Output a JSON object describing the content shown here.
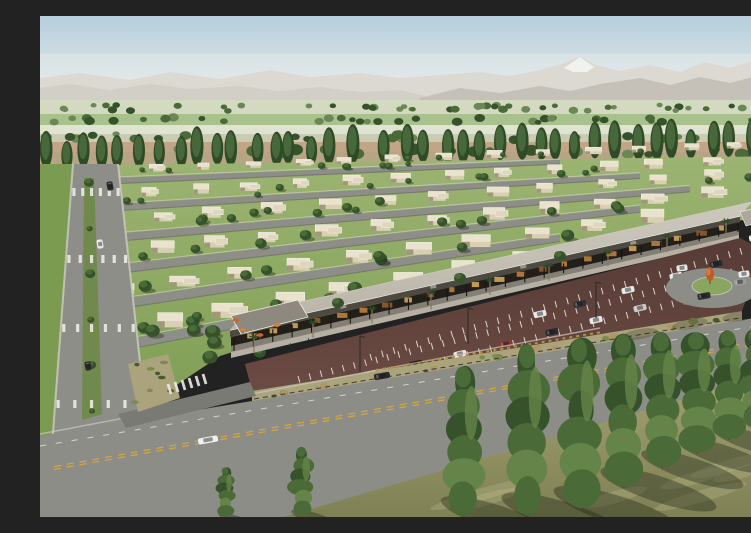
{
  "scene": {
    "meta": {
      "description": "Aerial architectural rendering of a desert master-planned community: rows of beige single-story homes with lawns, poplar-lined farm fields and hazy mountains with one snow peak behind, a retail strip with flat canopy, palm trees and orange cafe umbrellas, a maroon striped parking lot with cars, a landscaped boulevard, a roundabout with an orange feature tree, and a wide foreground road lined with tall columnar trees casting shadows on olive grass",
      "width": 751,
      "height": 501
    },
    "seed": 7,
    "sky": {
      "stops": [
        [
          "0%",
          "#b7cedd"
        ],
        [
          "55%",
          "#d6e1e4"
        ],
        [
          "100%",
          "#edeee6"
        ]
      ]
    },
    "mountains": {
      "base_y": 96,
      "back": [
        [
          0,
          62
        ],
        [
          40,
          57
        ],
        [
          90,
          64
        ],
        [
          130,
          56
        ],
        [
          180,
          63
        ],
        [
          230,
          54
        ],
        [
          270,
          61
        ],
        [
          320,
          57
        ],
        [
          360,
          62
        ],
        [
          400,
          59
        ],
        [
          440,
          56
        ],
        [
          470,
          60
        ],
        [
          500,
          54
        ],
        [
          524,
          47
        ],
        [
          540,
          40
        ],
        [
          556,
          49
        ],
        [
          580,
          55
        ],
        [
          610,
          49
        ],
        [
          640,
          56
        ],
        [
          665,
          46
        ],
        [
          690,
          52
        ],
        [
          715,
          44
        ],
        [
          750,
          49
        ]
      ],
      "front_left": [
        [
          0,
          72
        ],
        [
          30,
          68
        ],
        [
          70,
          74
        ],
        [
          110,
          68
        ],
        [
          150,
          73
        ],
        [
          200,
          70
        ],
        [
          240,
          75
        ],
        [
          280,
          71
        ],
        [
          320,
          76
        ],
        [
          360,
          74
        ],
        [
          385,
          80
        ]
      ],
      "front_right": [
        [
          380,
          82
        ],
        [
          420,
          72
        ],
        [
          460,
          77
        ],
        [
          500,
          70
        ],
        [
          530,
          75
        ],
        [
          560,
          68
        ],
        [
          600,
          62
        ],
        [
          630,
          69
        ],
        [
          660,
          61
        ],
        [
          690,
          67
        ],
        [
          720,
          59
        ],
        [
          750,
          63
        ]
      ],
      "snow": [
        [
          524,
          52
        ],
        [
          540,
          41
        ],
        [
          554,
          51
        ],
        [
          547,
          56
        ],
        [
          533,
          56
        ]
      ]
    },
    "fields": {
      "strips": [
        [
          84,
          14,
          "#d3dac1"
        ],
        [
          98,
          11,
          "#a9c18d"
        ],
        [
          109,
          9,
          "#dfe3d2"
        ],
        [
          118,
          8,
          "#c9ccb3"
        ],
        [
          126,
          10,
          "#c2a486"
        ],
        [
          136,
          14,
          "#b5a584"
        ]
      ],
      "tree_bands": [
        [
          92,
          46,
          3.5
        ],
        [
          104,
          34,
          4
        ],
        [
          121,
          26,
          4.5
        ],
        [
          136,
          22,
          5.5
        ]
      ]
    },
    "poplars": {
      "x0": 4,
      "x1": 748,
      "y0": 152,
      "y1": 140,
      "count": 40,
      "h_min": 28,
      "h_max": 40
    },
    "residential": {
      "area": [
        [
          0,
          150
        ],
        [
          750,
          140
        ],
        [
          750,
          200
        ],
        [
          660,
          208
        ],
        [
          430,
          262
        ],
        [
          180,
          340
        ],
        [
          60,
          420
        ],
        [
          0,
          424
        ]
      ],
      "streets": [
        [
          168,
          520,
          146,
          6
        ],
        [
          196,
          600,
          160,
          7
        ],
        [
          228,
          650,
          173,
          8
        ],
        [
          262,
          600,
          193,
          9
        ],
        [
          300,
          520,
          222,
          10
        ],
        [
          345,
          420,
          265,
          11
        ]
      ],
      "house_rows": [
        [
          160,
          0.04,
          16,
          13,
          7,
          8,
          740
        ],
        [
          186,
          0.055,
          15,
          16,
          9,
          0,
          710
        ],
        [
          214,
          0.075,
          14,
          18,
          10,
          0,
          720
        ],
        [
          248,
          0.1,
          13,
          20,
          11,
          0,
          660
        ],
        [
          288,
          0.135,
          11,
          23,
          12,
          15,
          600
        ],
        [
          332,
          0.175,
          8,
          26,
          14,
          55,
          470
        ]
      ],
      "orchard_cluster": {
        "x0": 140,
        "x1": 270,
        "y0": 295,
        "y1": 350,
        "count": 9
      }
    },
    "boulevard": {
      "poly": [
        [
          33,
          148
        ],
        [
          78,
          148
        ],
        [
          108,
          418
        ],
        [
          12,
          430
        ]
      ],
      "verge": [
        [
          0,
          148
        ],
        [
          33,
          148
        ],
        [
          12,
          430
        ],
        [
          0,
          432
        ]
      ],
      "median": [
        [
          44,
          162
        ],
        [
          54,
          162
        ],
        [
          62,
          398
        ],
        [
          42,
          404
        ]
      ],
      "median_tree_count": 6,
      "crosswalk_ys": [
        176,
        243,
        312,
        388
      ],
      "cars": [
        [
          60,
          228,
          "#e9e9e7"
        ],
        [
          70,
          170,
          "#2c2c30"
        ],
        [
          48,
          350,
          "#2c2c30"
        ]
      ]
    },
    "strip_mall": {
      "plaza": [
        [
          191,
          330
        ],
        [
          699,
          214
        ],
        [
          699,
          224
        ],
        [
          191,
          342
        ]
      ],
      "canopy_shadow": [
        [
          191,
          330
        ],
        [
          699,
          214
        ],
        [
          699,
          219
        ],
        [
          191,
          336
        ]
      ],
      "under": [
        [
          191,
          321
        ],
        [
          699,
          206
        ],
        [
          699,
          214
        ],
        [
          191,
          330
        ]
      ],
      "fascia": [
        [
          190,
          314
        ],
        [
          700,
          200
        ],
        [
          700,
          206
        ],
        [
          190,
          321
        ]
      ],
      "roof": [
        [
          190,
          314
        ],
        [
          700,
          200
        ],
        [
          712,
          186
        ],
        [
          202,
          299
        ]
      ],
      "gable": [
        [
          191,
          300
        ],
        [
          258,
          284
        ],
        [
          268,
          301
        ],
        [
          201,
          318
        ]
      ],
      "roof_units": [
        [
          300,
          290
        ],
        [
          390,
          270
        ],
        [
          480,
          250
        ],
        [
          590,
          226
        ]
      ],
      "roof_trees": [
        [
          298,
          287
        ],
        [
          420,
          262
        ],
        [
          520,
          240
        ]
      ],
      "glow_count": 22,
      "column_count": 27,
      "palms": {
        "x0": 214,
        "x1": 686,
        "y0": 336,
        "y1": 222,
        "count": 9
      },
      "umbrellas": [
        [
          203,
          318
        ],
        [
          220,
          323
        ],
        [
          237,
          313
        ],
        [
          196,
          308
        ]
      ],
      "people": [
        [
          250,
          330
        ],
        [
          268,
          325
        ],
        [
          300,
          320
        ],
        [
          330,
          312
        ],
        [
          360,
          306
        ]
      ]
    },
    "parking": {
      "poly": [
        [
          205,
          348
        ],
        [
          700,
          222
        ],
        [
          724,
          234
        ],
        [
          702,
          295
        ],
        [
          212,
          375
        ]
      ],
      "stripe_rows": [
        [
          245,
          380,
          700,
          268,
          40
        ],
        [
          258,
          360,
          702,
          250,
          40
        ],
        [
          330,
          338,
          700,
          232,
          32
        ]
      ],
      "cars": [
        [
          236,
          378,
          "#26262a"
        ],
        [
          283,
          370,
          "#e8e8e6"
        ],
        [
          330,
          358,
          "#bfc0c0"
        ],
        [
          376,
          348,
          "#1d1d21"
        ],
        [
          420,
          338,
          "#e6e6e4"
        ],
        [
          466,
          328,
          "#8a3a32"
        ],
        [
          512,
          316,
          "#2a2a2e"
        ],
        [
          556,
          304,
          "#e8e8e6"
        ],
        [
          600,
          292,
          "#c9c9c7"
        ],
        [
          648,
          280,
          "#2f2f33"
        ],
        [
          500,
          298,
          "#e8e8e6"
        ],
        [
          540,
          288,
          "#33343a"
        ],
        [
          588,
          274,
          "#e8e8e6"
        ],
        [
          636,
          260,
          "#e8e8e6"
        ],
        [
          676,
          248,
          "#2b2b2f"
        ]
      ]
    },
    "berm": {
      "poly": [
        [
          212,
          386
        ],
        [
          702,
          305
        ],
        [
          702,
          295
        ],
        [
          212,
          375
        ]
      ],
      "shrub_count": 20,
      "rail_a": [
        [
          214,
          383
        ],
        [
          700,
          302
        ]
      ],
      "rail_b": [
        [
          214,
          387
        ],
        [
          700,
          306
        ]
      ]
    },
    "roundabout": {
      "cx": 672,
      "cy": 272,
      "rx": 46,
      "ry": 20,
      "island_rx": 20,
      "island_ry": 9,
      "feature": [
        670,
        258
      ],
      "cars": [
        [
          704,
          258,
          "#ececea"
        ],
        [
          642,
          252,
          "#e8e8e6"
        ]
      ]
    },
    "right_edge": {
      "canopy": [
        [
          700,
          196
        ],
        [
          750,
          184
        ],
        [
          750,
          198
        ],
        [
          706,
          210
        ]
      ],
      "sign": [
        732,
        204,
        14,
        9
      ],
      "cars": [
        [
          714,
          222,
          "#e8e8e6"
        ],
        [
          736,
          228,
          "#d8d8d6"
        ]
      ]
    },
    "main_road": {
      "poly": [
        [
          0,
          420
        ],
        [
          750,
          296
        ],
        [
          750,
          352
        ],
        [
          250,
          501
        ],
        [
          0,
          501
        ]
      ],
      "access_road": [
        [
          78,
          398
        ],
        [
          210,
          366
        ],
        [
          216,
          380
        ],
        [
          86,
          412
        ]
      ],
      "island": [
        [
          88,
          348
        ],
        [
          128,
          338
        ],
        [
          140,
          382
        ],
        [
          98,
          396
        ]
      ],
      "center_line": [
        [
          14,
          452
        ],
        [
          744,
          322
        ]
      ],
      "edge_dash": [
        [
          0,
          430
        ],
        [
          740,
          306
        ]
      ],
      "curb_ticks": [
        [
          336,
          354
        ],
        [
          562,
          316
        ]
      ],
      "crosswalk_access": {
        "x0": 128,
        "y0": 368,
        "count": 6
      },
      "cars": [
        [
          168,
          424,
          "#efefed",
          20
        ],
        [
          342,
          360,
          "#2b2b2f",
          16
        ],
        [
          664,
          280,
          "#2e2e32",
          13
        ],
        [
          700,
          266,
          "#9a9a98",
          12
        ]
      ],
      "road_shadows": [
        [
          600,
          318
        ],
        [
          650,
          308
        ],
        [
          700,
          300
        ],
        [
          740,
          294
        ]
      ]
    },
    "foreground": {
      "grass": [
        [
          244,
          501
        ],
        [
          750,
          352
        ],
        [
          750,
          501
        ]
      ],
      "streak_count": 7,
      "trees": [
        [
          186,
          452,
          501
        ],
        [
          262,
          432,
          501
        ],
        [
          424,
          352,
          501
        ],
        [
          488,
          330,
          501
        ],
        [
          540,
          324,
          494
        ],
        [
          584,
          320,
          472
        ],
        [
          622,
          318,
          452
        ],
        [
          657,
          318,
          438
        ],
        [
          689,
          316,
          424
        ],
        [
          716,
          314,
          412
        ],
        [
          741,
          313,
          402
        ]
      ],
      "poles": [
        [
          320,
          320
        ],
        [
          428,
          292
        ],
        [
          556,
          266
        ]
      ]
    }
  },
  "palette": {
    "mtn_back": "#d2ccc2",
    "mtn_front_left": "#c2bbae",
    "mtn_front_right": "#a89f90",
    "snow": "#f5f3ef",
    "haze": "rgba(235,238,238,0.4)",
    "horizon_trees": "#7e9468",
    "poplar_dark": "#2f4a26",
    "poplar_mid": "#47683a",
    "lawn_top": "#9cb472",
    "lawn_bottom": "#7b9b50",
    "street": "#8e8e88",
    "street_dark": "#6c6c66",
    "sidewalk": "#cbc9c0",
    "house_wall": "#d9cfb3",
    "house_roof": "#e9e2cd",
    "house_wing": "#ded6bf",
    "house_shadow": "#a2967b",
    "house_trim": "#f4f0e4",
    "tree_dark": "#35522b",
    "tree_mid": "#4a6b37",
    "tree_light": "#648449",
    "canopy": "#b9b4a8",
    "canopy_light": "#ccc8bd",
    "fascia": "#4e4a42",
    "under_canopy": "#221f1b",
    "glow_a": "#b67a3a",
    "glow_b": "#8a5a2e",
    "glow_c": "#caa05a",
    "column": "#17150f",
    "plaza": "#b5b0a3",
    "gable_roof": "#8e897e",
    "parking_light": "#6b4b43",
    "parking_dark": "#573b36",
    "stall_stripe": "#e9e7e2",
    "road": "#8d8d87",
    "road_dark": "#7a7a74",
    "center_yellow": "#d7a63e",
    "white_mark": "#eceae4",
    "curb_tick": "#b9903a",
    "berm": "#aaa37c",
    "shrub_dark": "#49582f",
    "shrub_olive": "#7c8a4e",
    "shrub_tan": "#b09568",
    "rail_dark": "#3b3b33",
    "roundabout_island": "#8aa55f",
    "orange_feature": "#c05a2c",
    "orange_feature_hi": "#d97b3a",
    "umbrella_a": "#d2622a",
    "umbrella_b": "#e07b33",
    "red_sign": "#b23226",
    "grass_fg_top": "#a4a273",
    "grass_fg_bottom": "#7f8154",
    "grass_streak": "rgba(215,210,165,0.22)",
    "shadow": "rgba(30,38,22,0.38)",
    "trunk": "#5a4a32",
    "pole": "#2e2e2a",
    "person": "#2b2b2b"
  }
}
